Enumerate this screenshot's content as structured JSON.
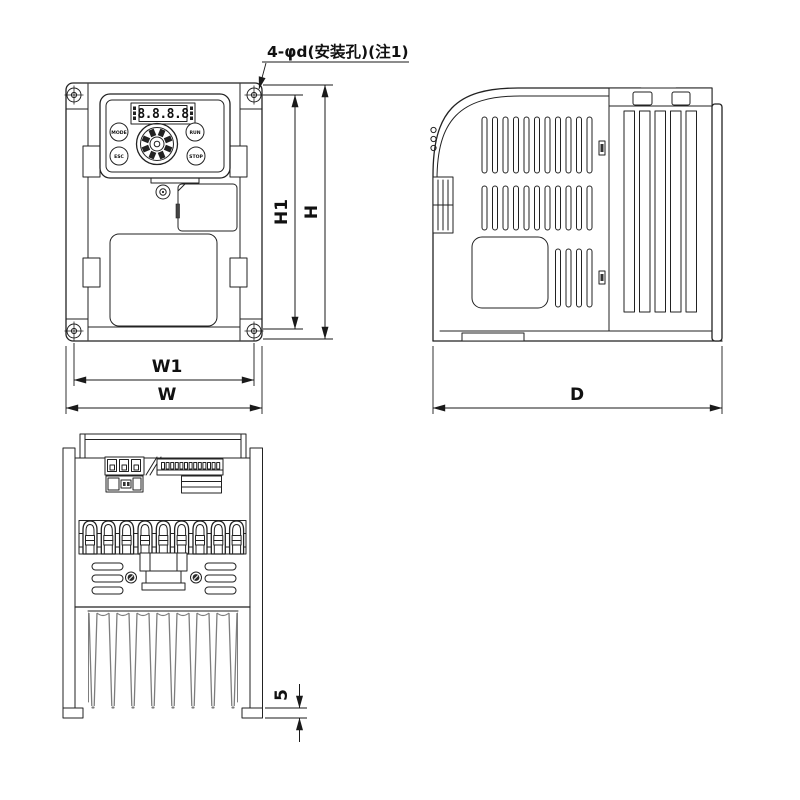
{
  "labels": {
    "annotation": "4-φd(安装孔)(注1)",
    "h1": "H1",
    "h": "H",
    "w1": "W1",
    "w": "W",
    "d": "D",
    "foot_height": "5"
  },
  "keypad": {
    "display": "8.8.8.8",
    "mode": "MODE",
    "run": "RUN",
    "esc": "ESC",
    "stop": "STOP"
  },
  "colors": {
    "line": "#222222",
    "fin_line": "#7d7d7d",
    "background": "#ffffff"
  }
}
